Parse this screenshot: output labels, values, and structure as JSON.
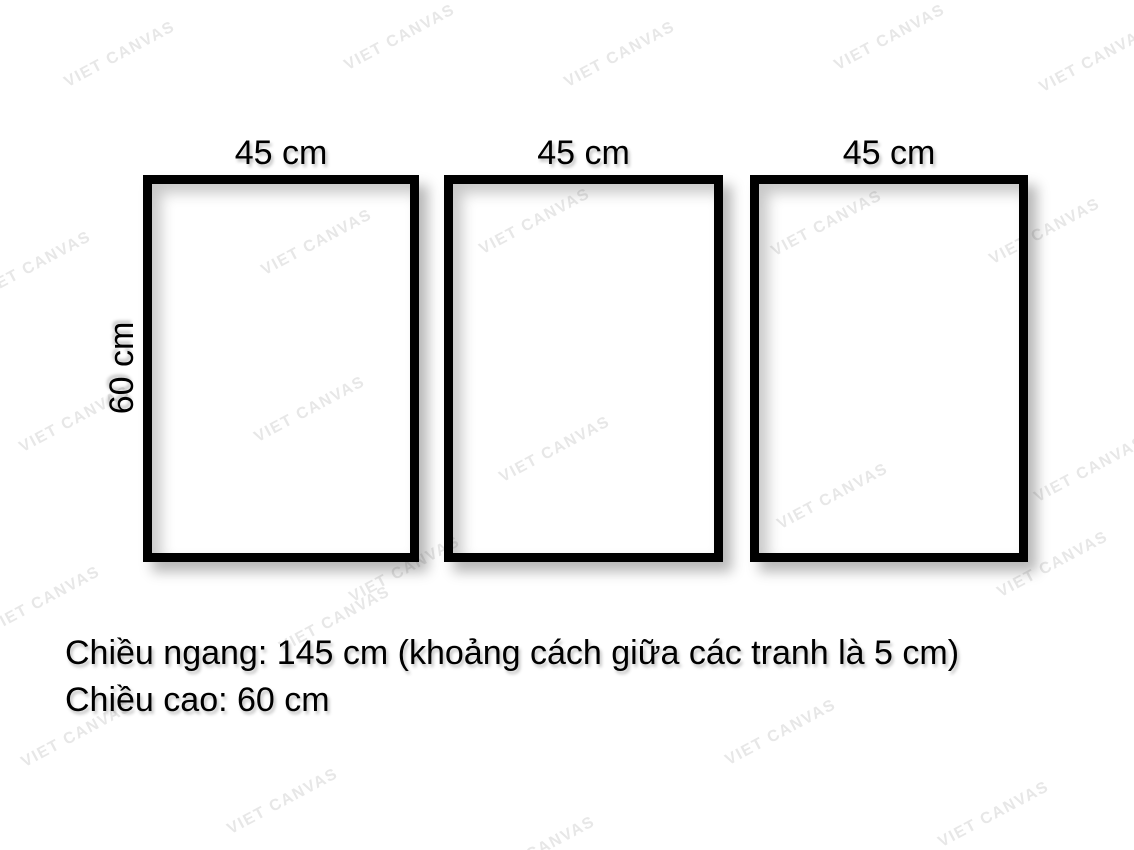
{
  "watermark": {
    "text": "VIET CANVAS",
    "color": "#e7e7e7"
  },
  "frames": [
    {
      "width_label": "45 cm"
    },
    {
      "width_label": "45 cm"
    },
    {
      "width_label": "45 cm"
    }
  ],
  "height_label": "60 cm",
  "caption": {
    "line1": "Chiều ngang: 145 cm (khoảng cách giữa các tranh là 5 cm)",
    "line2": "Chiều cao: 60 cm"
  },
  "colors": {
    "background": "#ffffff",
    "frame_border": "#000000",
    "text": "#000000"
  }
}
